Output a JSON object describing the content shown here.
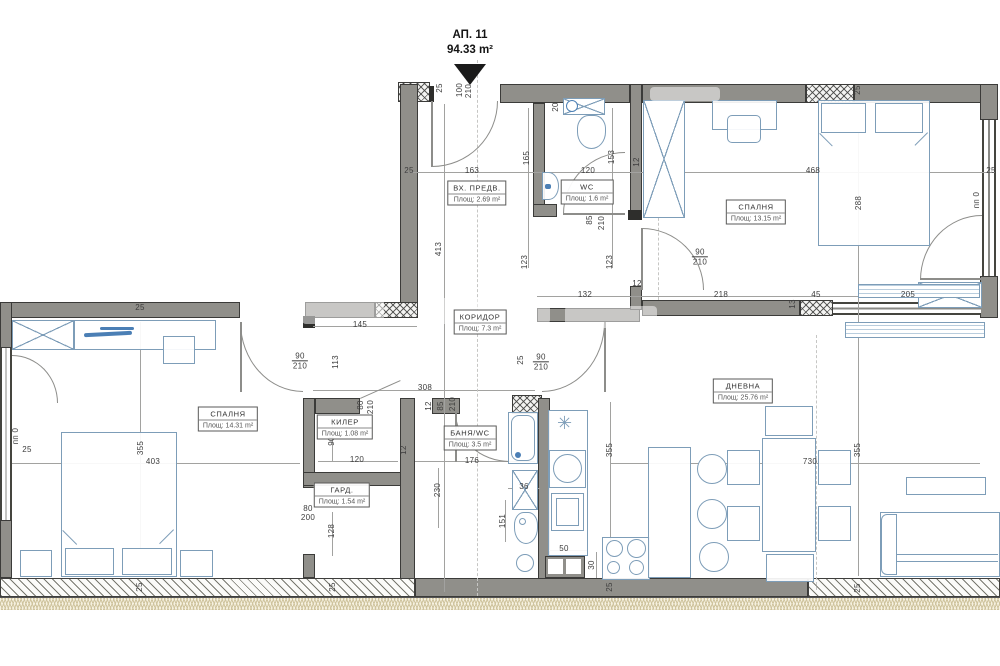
{
  "title": {
    "apartment": "АП. 11",
    "area": "94.33 m²"
  },
  "symbols": {
    "kitchen_star": "✳"
  },
  "colors": {
    "wall": "#908f8a",
    "furniture_line": "#7d9db8",
    "accent_blue": "#4b7fb5",
    "dim_text": "#3d3d3d",
    "insulation": "#f6f1e0"
  },
  "rooms": [
    {
      "name": "ВХ. ПРЕДВ.",
      "area": "Площ: 2.69 m²",
      "x": 477,
      "y": 193
    },
    {
      "name": "WC",
      "area": "Площ: 1.6 m²",
      "x": 587,
      "y": 192
    },
    {
      "name": "СПАЛНЯ",
      "area": "Площ: 13.15 m²",
      "x": 756,
      "y": 212
    },
    {
      "name": "КОРИДОР",
      "area": "Площ: 7.3 m²",
      "x": 480,
      "y": 322
    },
    {
      "name": "СПАЛНЯ",
      "area": "Площ: 14.31 m²",
      "x": 228,
      "y": 419
    },
    {
      "name": "КИЛЕР",
      "area": "Площ: 1.08 m²",
      "x": 345,
      "y": 427
    },
    {
      "name": "БАНЯ/WC",
      "area": "Площ: 3.5 m²",
      "x": 470,
      "y": 438
    },
    {
      "name": "ГАРД.",
      "area": "Площ: 1.54 m²",
      "x": 342,
      "y": 495
    },
    {
      "name": "ДНЕВНА",
      "area": "Площ: 25.76 m²",
      "x": 743,
      "y": 391
    }
  ],
  "dims": [
    {
      "t": "25",
      "x": 440,
      "y": 88,
      "o": "v"
    },
    {
      "t": "100",
      "x": 460,
      "y": 90,
      "o": "v"
    },
    {
      "t": "210",
      "x": 469,
      "y": 91,
      "o": "v"
    },
    {
      "t": "25",
      "x": 409,
      "y": 171,
      "o": "h"
    },
    {
      "t": "163",
      "x": 472,
      "y": 171,
      "o": "h"
    },
    {
      "t": "165",
      "x": 527,
      "y": 158,
      "o": "v"
    },
    {
      "t": "120",
      "x": 588,
      "y": 171,
      "o": "h"
    },
    {
      "t": "153",
      "x": 612,
      "y": 157,
      "o": "v"
    },
    {
      "t": "12",
      "x": 637,
      "y": 162,
      "o": "v"
    },
    {
      "t": "20",
      "x": 556,
      "y": 107,
      "o": "v"
    },
    {
      "t": "25",
      "x": 858,
      "y": 90,
      "o": "v"
    },
    {
      "t": "468",
      "x": 813,
      "y": 171,
      "o": "h"
    },
    {
      "t": "288",
      "x": 859,
      "y": 203,
      "o": "v"
    },
    {
      "t": "25",
      "x": 991,
      "y": 171,
      "o": "h"
    },
    {
      "t": "пп 0",
      "x": 977,
      "y": 200,
      "o": "v"
    },
    {
      "t": "85",
      "x": 590,
      "y": 220,
      "o": "v"
    },
    {
      "t": "210",
      "x": 602,
      "y": 223,
      "o": "v"
    },
    {
      "t": "90/210",
      "x": 700,
      "y": 257,
      "o": "f"
    },
    {
      "t": "123",
      "x": 525,
      "y": 262,
      "o": "v"
    },
    {
      "t": "123",
      "x": 610,
      "y": 262,
      "o": "v"
    },
    {
      "t": "132",
      "x": 585,
      "y": 295,
      "o": "h"
    },
    {
      "t": "12",
      "x": 637,
      "y": 284,
      "o": "h"
    },
    {
      "t": "218",
      "x": 721,
      "y": 295,
      "o": "h"
    },
    {
      "t": "45",
      "x": 816,
      "y": 295,
      "o": "h"
    },
    {
      "t": "13",
      "x": 793,
      "y": 304,
      "o": "v"
    },
    {
      "t": "205",
      "x": 908,
      "y": 295,
      "o": "h"
    },
    {
      "t": "25",
      "x": 140,
      "y": 308,
      "o": "h"
    },
    {
      "t": "413",
      "x": 439,
      "y": 249,
      "o": "v"
    },
    {
      "t": "145",
      "x": 360,
      "y": 325,
      "o": "h"
    },
    {
      "t": "90/210",
      "x": 300,
      "y": 361,
      "o": "f"
    },
    {
      "t": "113",
      "x": 336,
      "y": 362,
      "o": "v"
    },
    {
      "t": "25",
      "x": 521,
      "y": 360,
      "o": "v"
    },
    {
      "t": "90/210",
      "x": 541,
      "y": 362,
      "o": "f"
    },
    {
      "t": "308",
      "x": 425,
      "y": 388,
      "o": "h"
    },
    {
      "t": "12",
      "x": 429,
      "y": 406,
      "o": "v"
    },
    {
      "t": "85",
      "x": 441,
      "y": 406,
      "o": "v"
    },
    {
      "t": "210",
      "x": 453,
      "y": 404,
      "o": "v"
    },
    {
      "t": "80",
      "x": 361,
      "y": 405,
      "o": "v"
    },
    {
      "t": "210",
      "x": 371,
      "y": 407,
      "o": "v"
    },
    {
      "t": "90",
      "x": 332,
      "y": 441,
      "o": "v"
    },
    {
      "t": "120",
      "x": 357,
      "y": 460,
      "o": "h"
    },
    {
      "t": "12",
      "x": 404,
      "y": 450,
      "o": "v"
    },
    {
      "t": "176",
      "x": 472,
      "y": 461,
      "o": "h"
    },
    {
      "t": "230",
      "x": 438,
      "y": 490,
      "o": "v"
    },
    {
      "t": "80",
      "x": 308,
      "y": 509,
      "o": "h"
    },
    {
      "t": "200",
      "x": 308,
      "y": 518,
      "o": "h"
    },
    {
      "t": "128",
      "x": 332,
      "y": 531,
      "o": "v"
    },
    {
      "t": "36",
      "x": 524,
      "y": 487,
      "o": "h"
    },
    {
      "t": "151",
      "x": 503,
      "y": 521,
      "o": "v"
    },
    {
      "t": "50",
      "x": 564,
      "y": 549,
      "o": "h"
    },
    {
      "t": "30",
      "x": 592,
      "y": 565,
      "o": "v"
    },
    {
      "t": "25",
      "x": 610,
      "y": 587,
      "o": "v"
    },
    {
      "t": "403",
      "x": 153,
      "y": 462,
      "o": "h"
    },
    {
      "t": "355",
      "x": 141,
      "y": 448,
      "o": "v"
    },
    {
      "t": "25",
      "x": 27,
      "y": 450,
      "o": "h"
    },
    {
      "t": "пп 0",
      "x": 16,
      "y": 436,
      "o": "v"
    },
    {
      "t": "355",
      "x": 610,
      "y": 450,
      "o": "v"
    },
    {
      "t": "355",
      "x": 858,
      "y": 450,
      "o": "v"
    },
    {
      "t": "730",
      "x": 810,
      "y": 462,
      "o": "h"
    },
    {
      "t": "25",
      "x": 140,
      "y": 587,
      "o": "v"
    },
    {
      "t": "25",
      "x": 333,
      "y": 587,
      "o": "v"
    },
    {
      "t": "25",
      "x": 858,
      "y": 588,
      "o": "v"
    }
  ]
}
